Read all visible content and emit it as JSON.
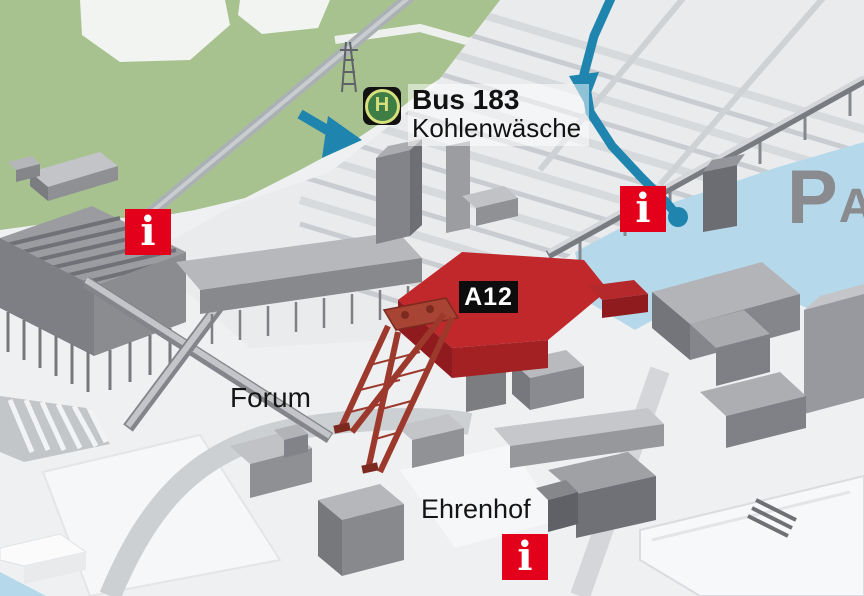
{
  "map": {
    "bus_stop": {
      "sign_letter": "H",
      "line": "Bus 183",
      "name": "Kohlenwäsche"
    },
    "building_badge": {
      "label": "A12"
    },
    "area_labels": {
      "forum": "Forum",
      "ehrenhof": "Ehrenhof"
    },
    "parking": {
      "letter": "P",
      "zone": "A2"
    },
    "info_markers": [
      {
        "id": "info-left",
        "glyph": "i"
      },
      {
        "id": "info-bridge",
        "glyph": "i"
      },
      {
        "id": "info-ehrenhof",
        "glyph": "i"
      }
    ],
    "colors": {
      "park_green": "#a7c28f",
      "parking_blue": "#b5d9ea",
      "route_teal": "#1f85ae",
      "landmark_red": "#c1282b",
      "marker_red": "#e2001a"
    }
  }
}
